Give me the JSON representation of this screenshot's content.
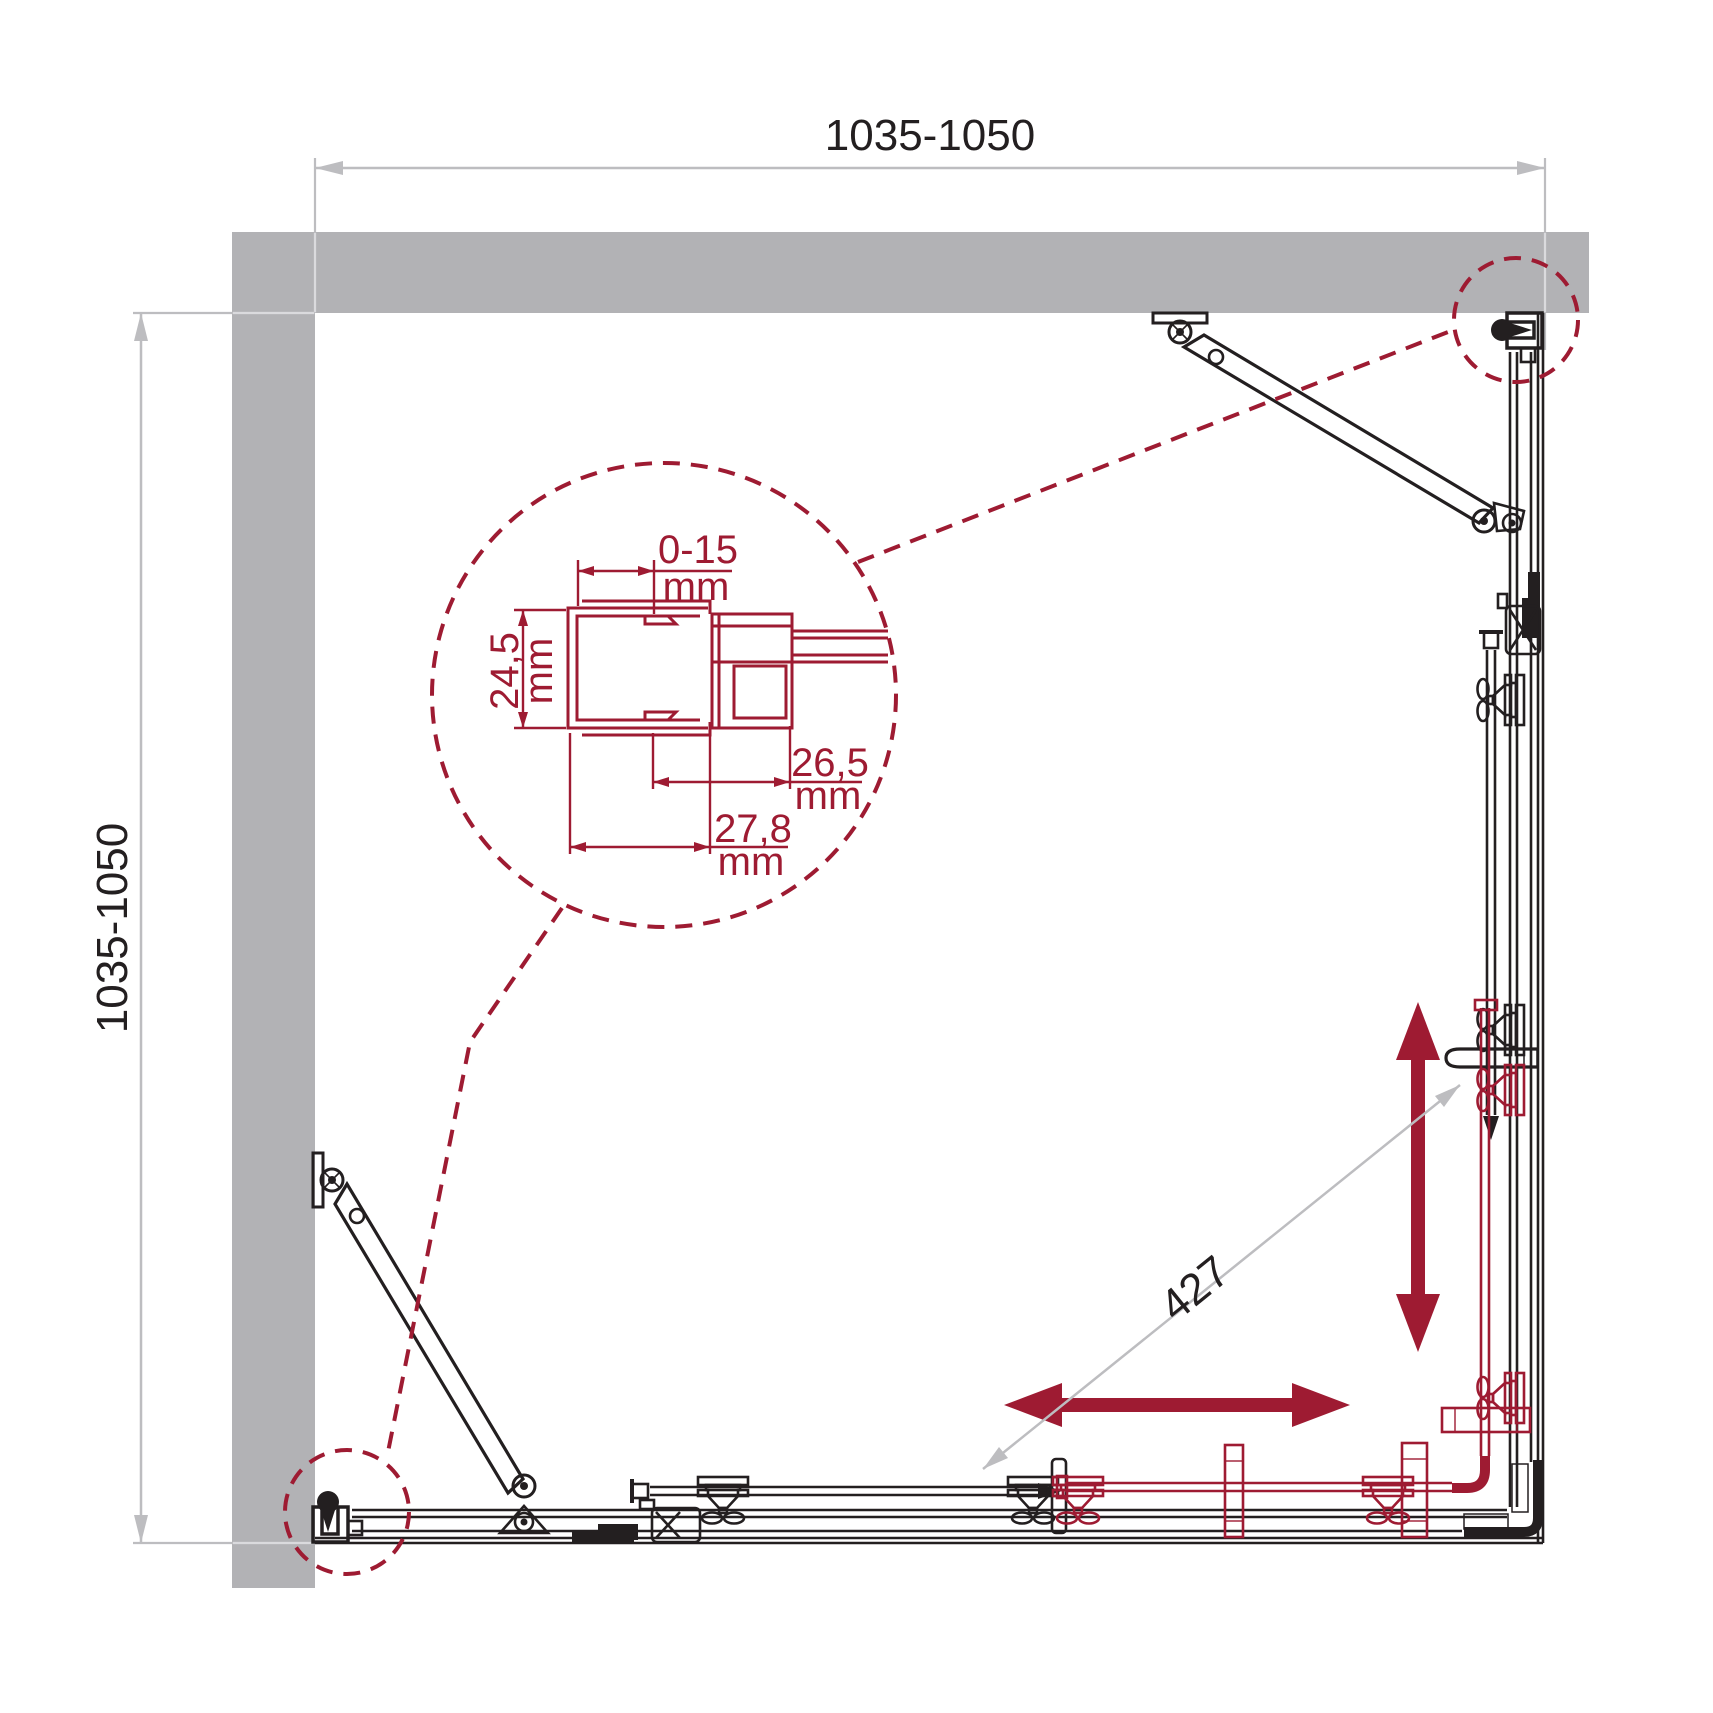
{
  "drawing": {
    "kind": "shower-enclosure corner installation, plan view",
    "units": "mm"
  },
  "colors": {
    "accent": "#9e1b32",
    "wall": "#b2b2b5",
    "line": "#231f20",
    "dim": "#bdbdc0",
    "dimlight": "#dadadd",
    "bg": "#ffffff"
  },
  "labels": {
    "width": "1035-1050",
    "depth": "1035-1050",
    "opening": "427"
  },
  "detail": {
    "gap": {
      "value": "0-15",
      "unit": "mm"
    },
    "depth": {
      "value": "24,5",
      "unit": "mm"
    },
    "outer": {
      "value": "26,5",
      "unit": "mm"
    },
    "profile": {
      "value": "27,8",
      "unit": "mm"
    }
  }
}
